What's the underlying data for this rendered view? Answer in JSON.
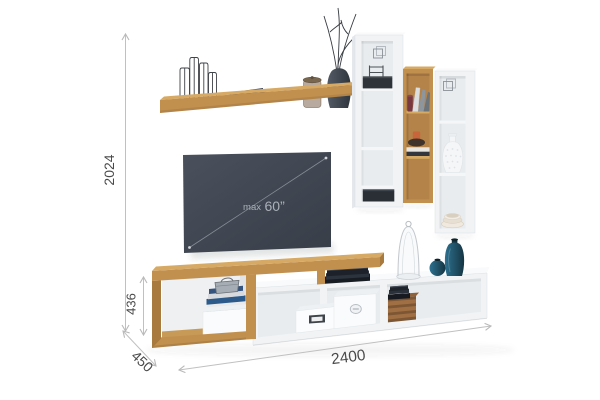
{
  "annotations": {
    "total_height": "2024",
    "stand_height": "436",
    "depth": "450",
    "total_width": "2400"
  },
  "tv": {
    "label_prefix": "max",
    "label_size": "60”"
  },
  "colors": {
    "bg": "#ffffff",
    "wood": "#c2904e",
    "wood_light": "#d6a964",
    "wood_dark": "#a87a3e",
    "wood_interior": "#b4834a",
    "white_unit": "#f1f3f5",
    "white_top": "#f9fafb",
    "white_side": "#e4e8ec",
    "interior": "#e8ecef",
    "edge": "#d9dee2",
    "tv_screen_top": "#4a505c",
    "tv_screen_bottom": "#383e48",
    "tv_text": "#abb0b8",
    "dim_line": "#c0c0c0",
    "dim_text": "#4a4a4a",
    "teal_light": "#2d7190",
    "teal_dark": "#153542",
    "dark_item": "#2b3036",
    "crate_brown": "#7d5633"
  }
}
